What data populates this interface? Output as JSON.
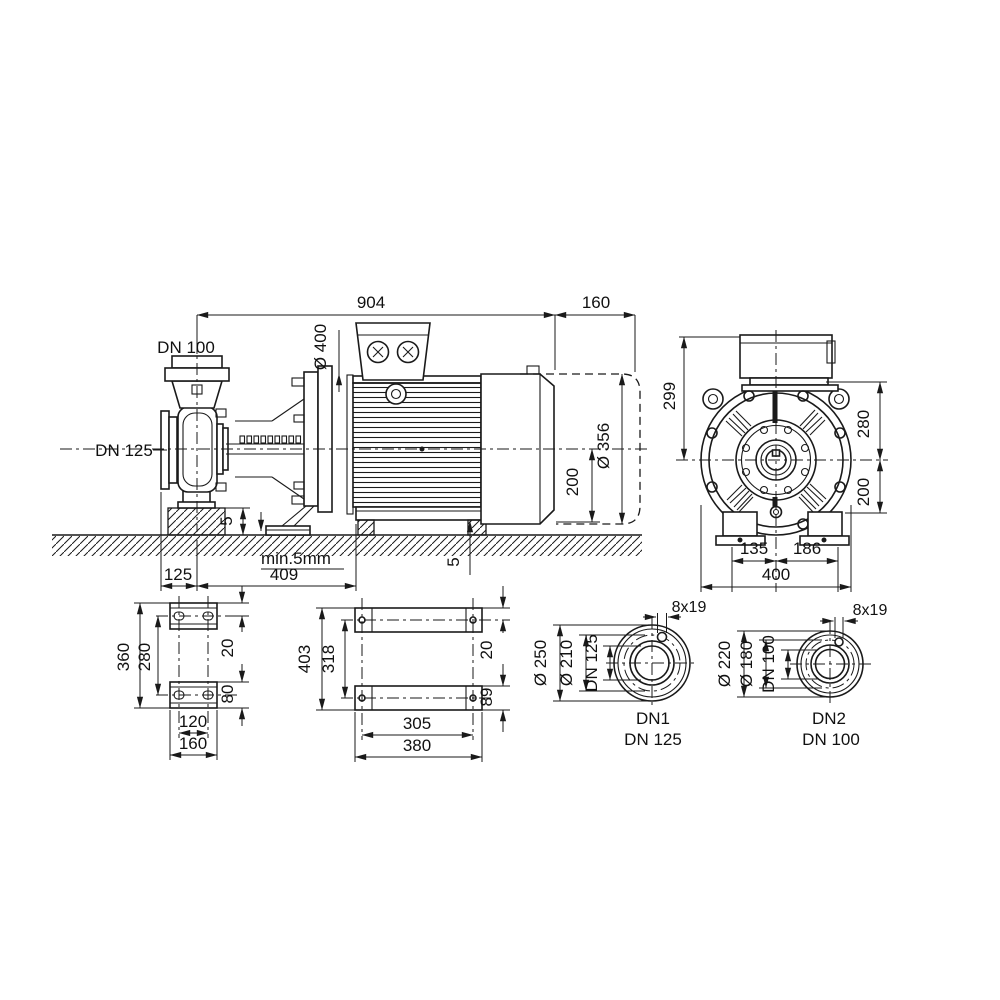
{
  "drawing": {
    "title_hint": "pump dimensional drawing",
    "colors": {
      "line": "#1a1a1a",
      "background": "#ffffff"
    },
    "side": {
      "dim_overall": "904",
      "dim_rear_space": "160",
      "label_discharge": "DN 100",
      "label_suction": "DN 125",
      "dim_flange_dia": "Ø 400",
      "dim_motor_dia": "Ø 356",
      "dim_axis_height": "200",
      "dim_pedestal": "5",
      "dim_shim": "5",
      "note_min_gap": "min.5mm",
      "dim_suction_offset": "125",
      "dim_axis_to_face": "409"
    },
    "front": {
      "dim_box_top": "299",
      "dim_upper": "280",
      "dim_lower": "200",
      "dim_foot_left": "135",
      "dim_foot_right": "186",
      "dim_width": "400"
    },
    "pump_foot": {
      "dim_length": "360",
      "dim_hole_span": "280",
      "dim_slot_offset": "20",
      "dim_pad": "80",
      "dim_hole_spacing": "120",
      "dim_width": "160"
    },
    "motor_foot": {
      "dim_length": "403",
      "dim_hole_span": "318",
      "dim_hole_offset": "20",
      "dim_pad": "89",
      "dim_hole_spacing": "305",
      "dim_width": "380"
    },
    "dn1": {
      "bolt_note": "8x19",
      "dim_outer": "Ø 250",
      "dim_bolt_circle": "Ø 210",
      "dim_bore": "DN 125",
      "port": "DN1",
      "size": "DN 125"
    },
    "dn2": {
      "bolt_note": "8x19",
      "dim_outer": "Ø 220",
      "dim_bolt_circle": "Ø 180",
      "dim_bore": "DN 100",
      "port": "DN2",
      "size": "DN 100"
    }
  }
}
